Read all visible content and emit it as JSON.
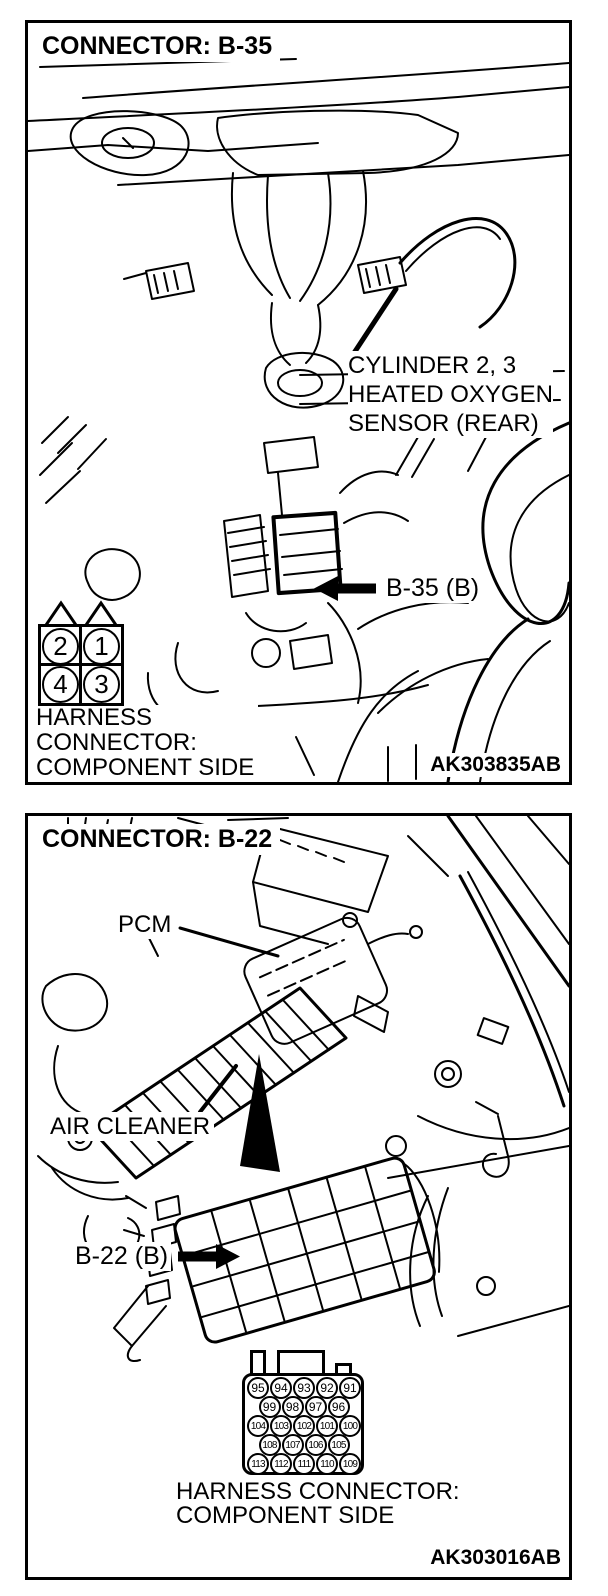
{
  "document": {
    "background": "#ffffff",
    "ink": "#000000"
  },
  "panels": [
    {
      "title": "CONNECTOR: B-35",
      "figure_id": "AK303835AB",
      "sensor_label": {
        "line1": "CYLINDER 2, 3",
        "line2": "HEATED OXYGEN",
        "line3": "SENSOR (REAR)"
      },
      "connector_callout": "B-35 (B)",
      "harness_label": {
        "line1": "HARNESS",
        "line2": "CONNECTOR:",
        "line3": "COMPONENT SIDE"
      },
      "pinout_rows": [
        [
          "2",
          "1"
        ],
        [
          "4",
          "3"
        ]
      ]
    },
    {
      "title": "CONNECTOR: B-22",
      "figure_id": "AK303016AB",
      "pcm_label": "PCM",
      "air_cleaner_label": "AIR CLEANER",
      "connector_callout": "B-22 (B)",
      "harness_label": {
        "line1": "HARNESS CONNECTOR:",
        "line2": "COMPONENT SIDE"
      },
      "pinout_rows": [
        [
          "95",
          "94",
          "93",
          "92",
          "91"
        ],
        [
          "99",
          "98",
          "97",
          "96"
        ],
        [
          "104",
          "103",
          "102",
          "101",
          "100"
        ],
        [
          "108",
          "107",
          "106",
          "105"
        ],
        [
          "113",
          "112",
          "111",
          "110",
          "109"
        ]
      ]
    }
  ]
}
